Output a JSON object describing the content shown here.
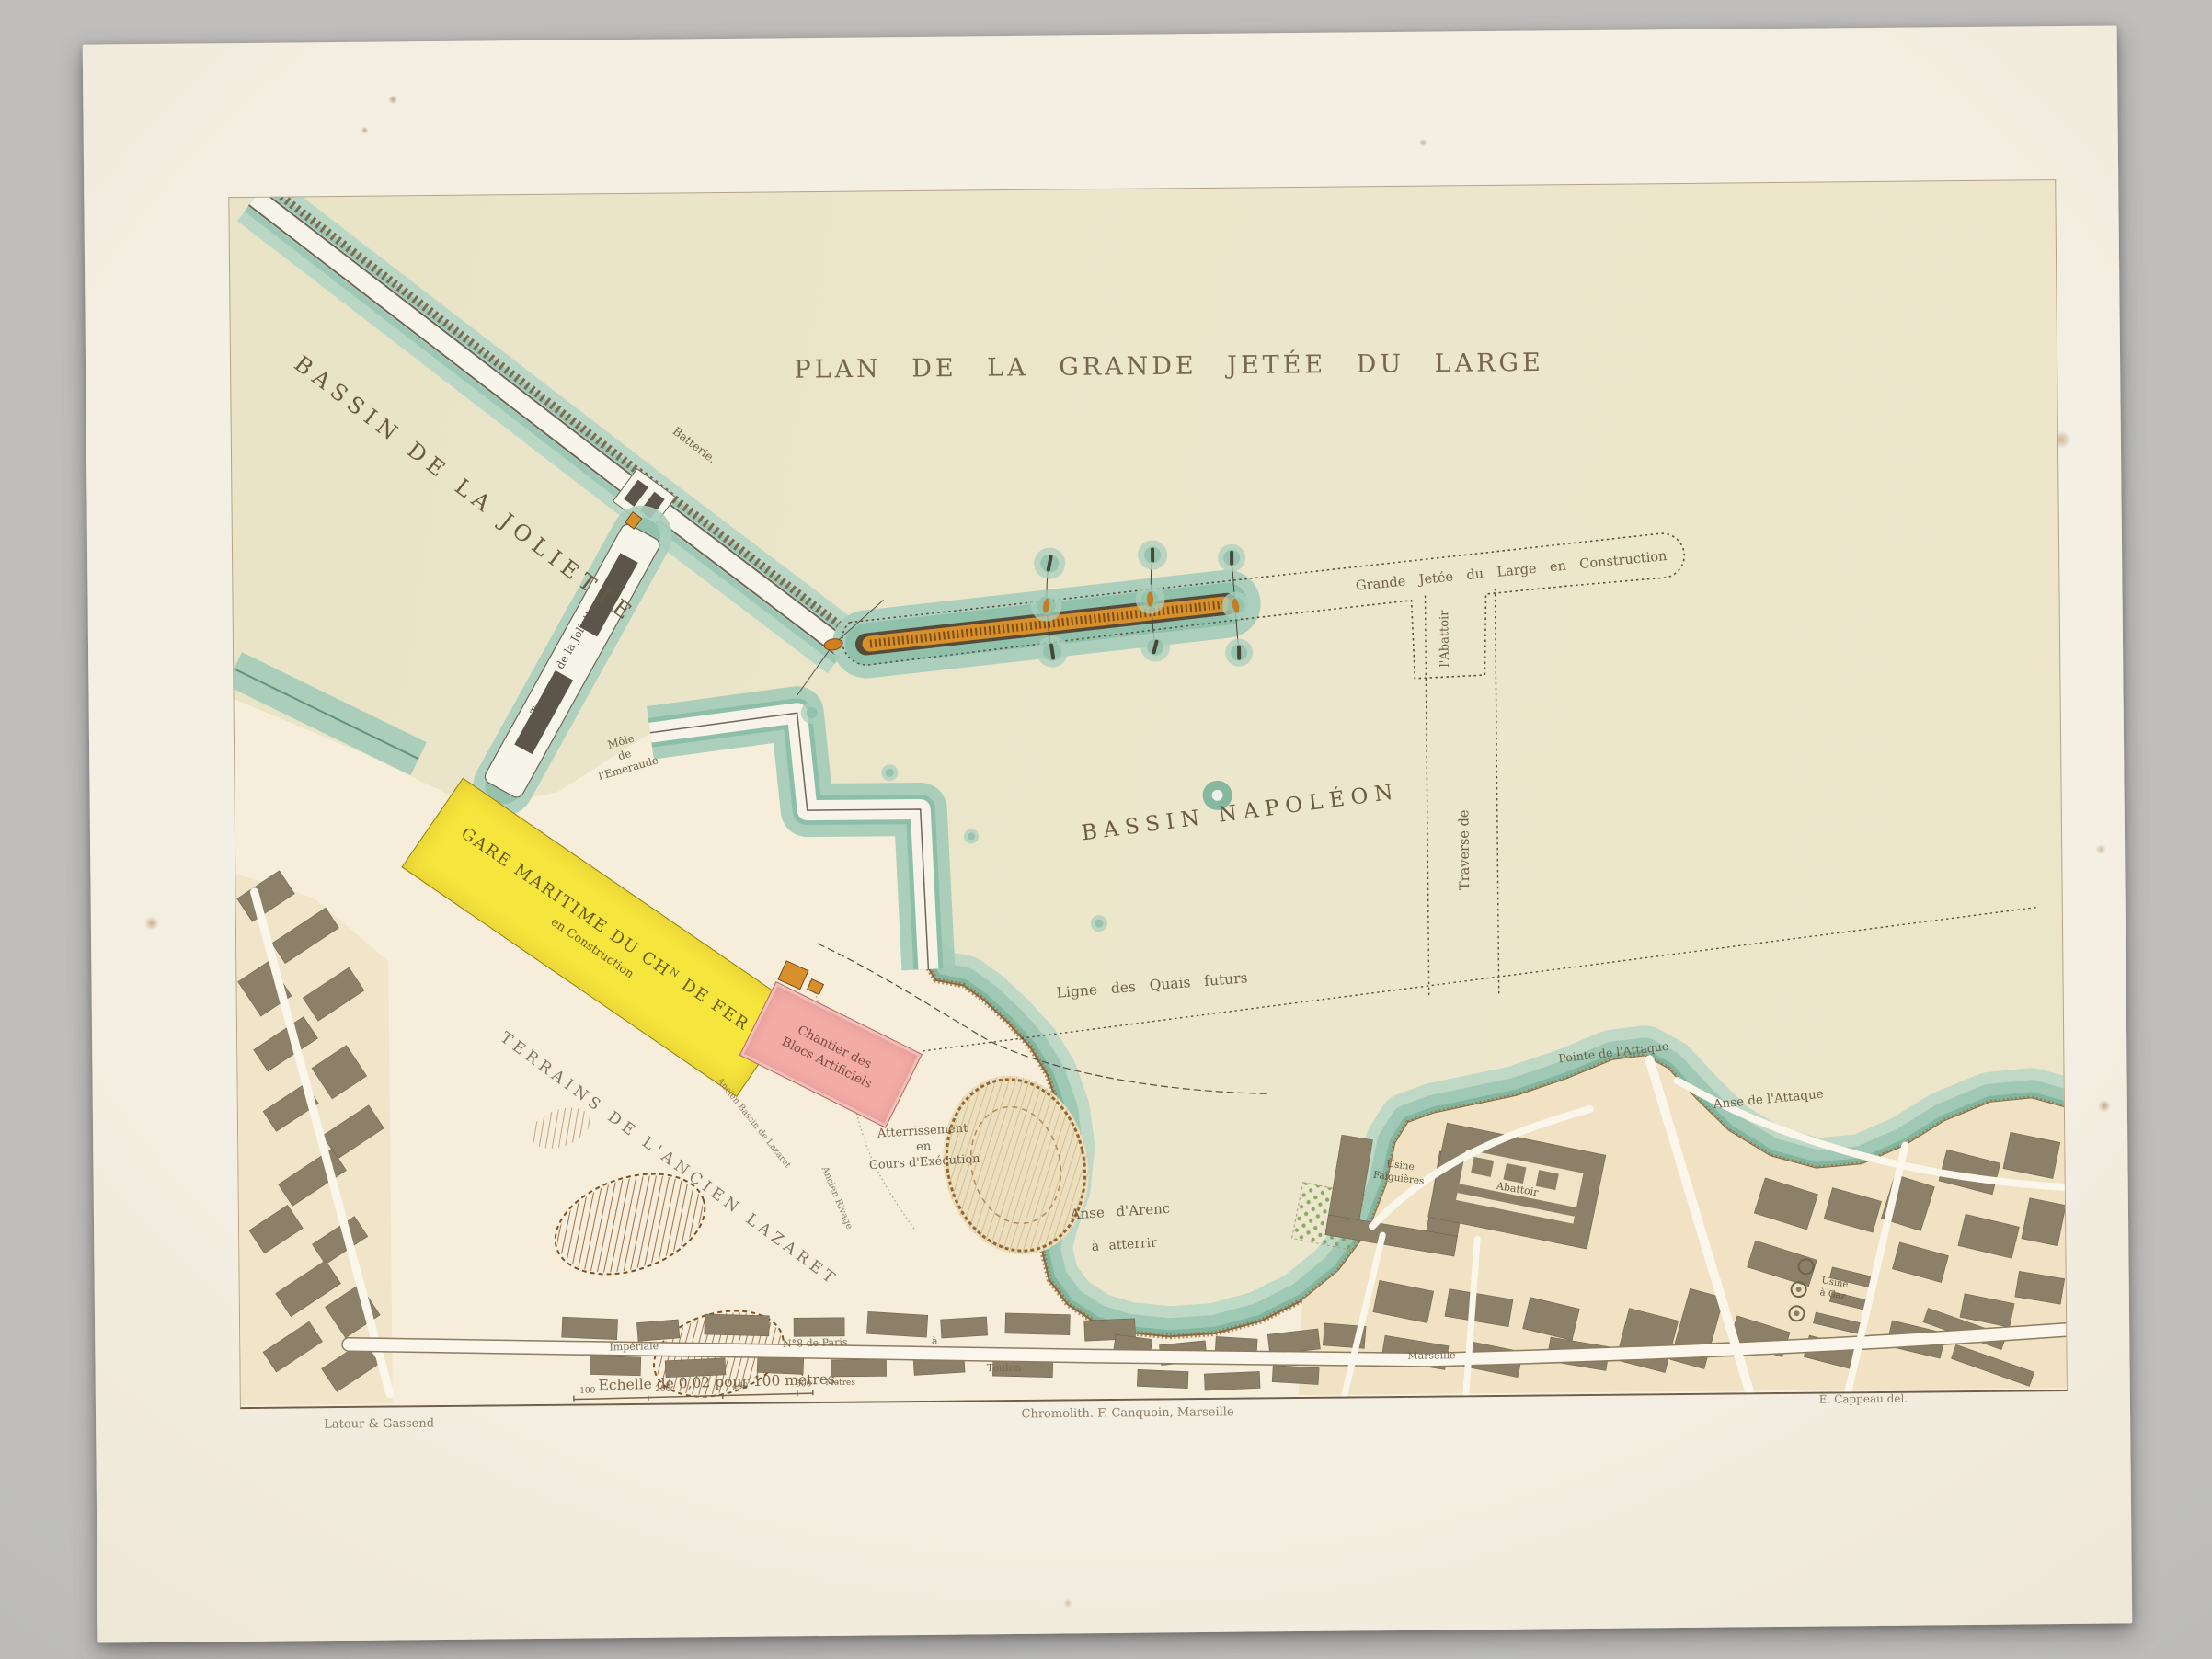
{
  "header": {
    "title": "TRAVAUX HYDRAULIQUES MARITIMES.",
    "subtitle": "Construction du Bassin Napoléon à Marseille.",
    "plate_prefix": "Pl.",
    "plate_number": "XX."
  },
  "map": {
    "title": "PLAN DE LA GRANDE JETÉE DU LARGE",
    "labels": {
      "bassin_joliette": "BASSIN DE LA JOLIETTE",
      "batterie": "Batterie.",
      "traverse_joliette": "Traverse de la Joliette.",
      "grande_jetee": "Grande Jetée du Large en Construction",
      "abattoir_stub": "l'Abattoir",
      "bassin_napoleon": "BASSIN NAPOLÉON",
      "traverse_de": "Traverse de",
      "ligne_quais": "Ligne des Quais futurs",
      "mole_l1": "Môle",
      "mole_l2": "de",
      "mole_l3": "l'Emeraude",
      "gare_l1": "GARE MARITIME DU CHᴺ DE FER",
      "gare_l2": "en Construction",
      "chantier_l1": "Chantier des",
      "chantier_l2": "Blocs Artificiels",
      "terrains": "TERRAINS DE L'ANCIEN LAZARET",
      "ancien_bassin": "Ancien Bassin de Lazaret",
      "ancien_rivage": "Ancien Rivage",
      "atter_l1": "Atterrissement",
      "atter_l2": "en",
      "atter_l3": "Cours d'Exécution",
      "anse_arenc_l1": "Anse  d'Arenc",
      "anse_arenc_l2": "à  atterrir",
      "pointe_attaque": "Pointe de l'Attaque",
      "anse_attaque": "Anse de l'Attaque",
      "usine_falg_l1": "Usine",
      "usine_falg_l2": "Falguières",
      "abattoir_city": "Abattoir",
      "usine_gaz_l1": "Usine",
      "usine_gaz_l2": "à Gaz",
      "route_imperiale": "Impériale",
      "route_n8": "N°8 de Paris",
      "route_a": "à",
      "route_toulon": "Toulon",
      "route_marseille": "Marseille"
    },
    "colors": {
      "paper": "#f2ecdf",
      "sea": "#e9e4c6",
      "water_edge_teal": "#8fc0aa",
      "jetty_orange": "#d8902d",
      "gare_yellow": "#f6e53d",
      "chantier_pink": "#f2aba5",
      "city_block": "#8c8168",
      "ink": "#6f5f46"
    }
  },
  "scale": {
    "text": "Echelle de 0,02 pour 100 mètres.",
    "ticks": [
      "100",
      "200",
      "400",
      "500"
    ],
    "unit": "Mètres"
  },
  "credits": {
    "left": "Latour & Gassend",
    "center": "Chromolith. F. Canquoin, Marseille",
    "right": "E. Cappeau del."
  }
}
